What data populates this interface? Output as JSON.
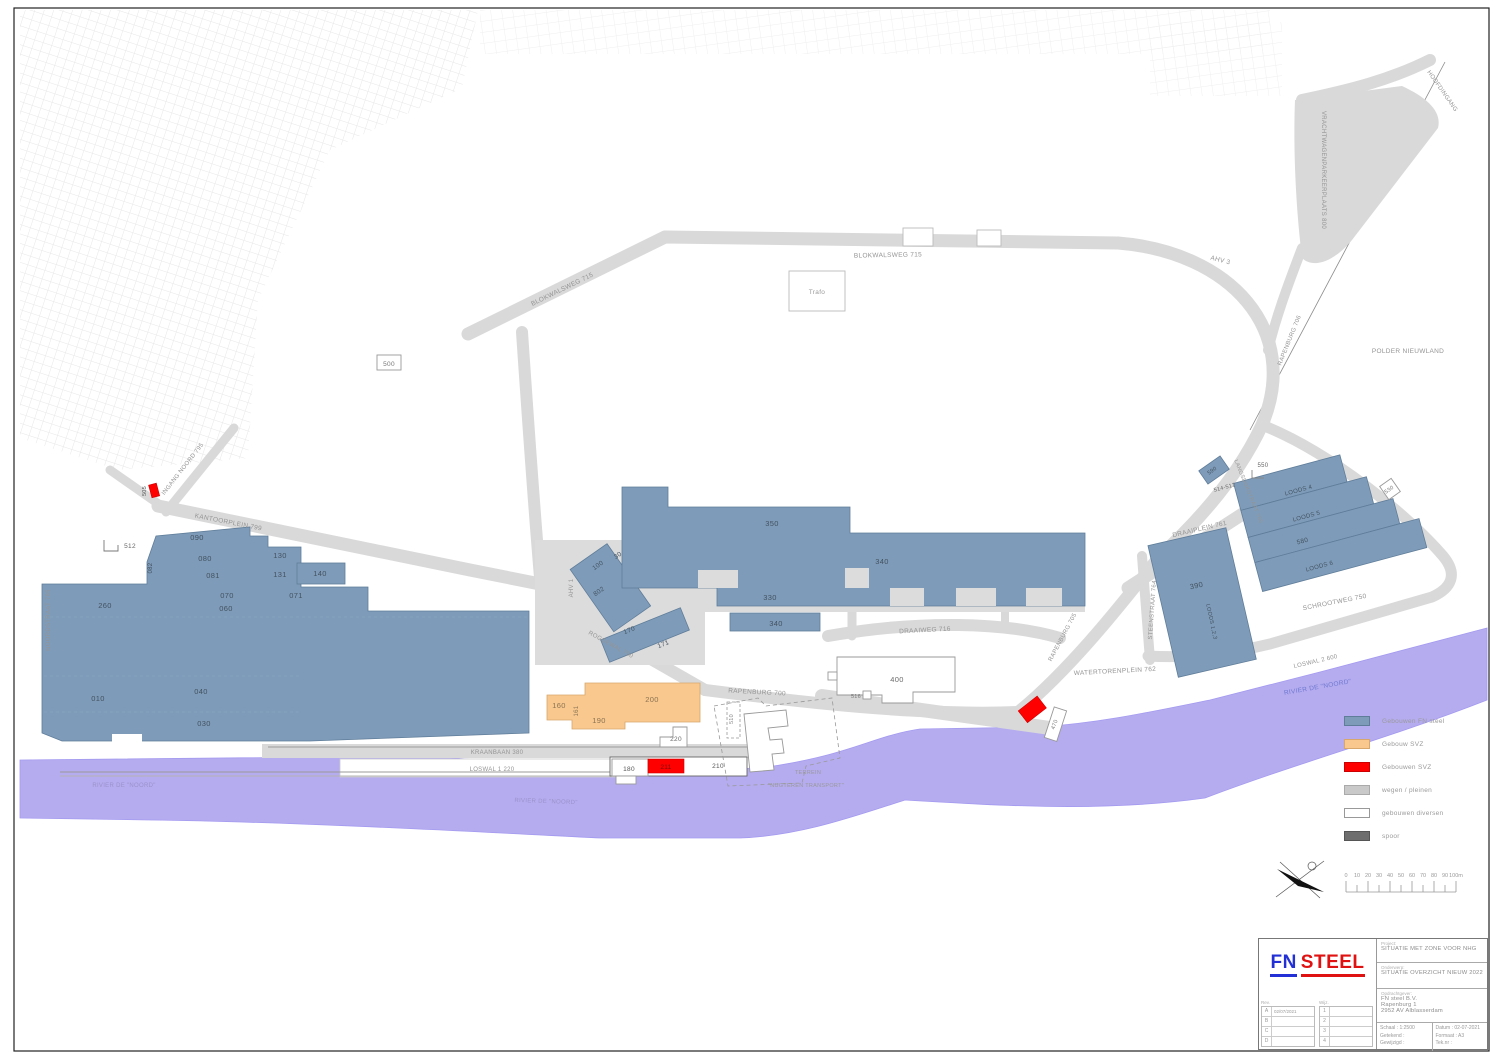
{
  "colors": {
    "fn_blue_building": "#7E9CBA",
    "svz_orange": "#F8C88F",
    "svz_red": "#FF0000",
    "road_gray": "#D9D9D9",
    "water_purple": "#B5ACF0",
    "spoor_gray": "#6E6E6E",
    "logo_blue": "#2230d6",
    "logo_red": "#e01111"
  },
  "map": {
    "road_labels": [
      {
        "name": "road-blokwalsweg-west",
        "text": "BLOKWALSWEG 715",
        "x": 563,
        "y": 291,
        "r": -26,
        "s": 6.5
      },
      {
        "name": "road-blokwalsweg",
        "text": "BLOKWALSWEG 715",
        "x": 888,
        "y": 257,
        "r": -1,
        "s": 6.5
      },
      {
        "name": "road-ahv-3",
        "text": "AHV 3",
        "x": 1220,
        "y": 262,
        "r": 14,
        "s": 6.5
      },
      {
        "name": "road-rapenburg-706",
        "text": "RAPENBURG 706",
        "x": 1291,
        "y": 341,
        "r": -68,
        "s": 6
      },
      {
        "name": "road-ingang-noord",
        "text": "INGANG NOORD 795",
        "x": 184,
        "y": 470,
        "r": -52,
        "s": 6
      },
      {
        "name": "road-noordstraat",
        "text": "NOORDSTRAAT 785",
        "x": 50,
        "y": 620,
        "r": -90,
        "s": 6
      },
      {
        "name": "road-kantoorplein",
        "text": "KANTOORPLEIN 799",
        "x": 228,
        "y": 524,
        "r": 11,
        "s": 6.5
      },
      {
        "name": "road-ahv-1",
        "text": "AHV 1",
        "x": 573,
        "y": 588,
        "r": -90,
        "s": 6
      },
      {
        "name": "road-roggewal",
        "text": "ROGGEWAL 750",
        "x": 610,
        "y": 646,
        "r": 29,
        "s": 6
      },
      {
        "name": "road-draaiweg",
        "text": "DRAAIWEG 716",
        "x": 925,
        "y": 632,
        "r": -3,
        "s": 6.5
      },
      {
        "name": "road-rapenburg-700",
        "text": "RAPENBURG 700",
        "x": 757,
        "y": 694,
        "r": 3,
        "s": 6.5
      },
      {
        "name": "road-rapenburg-705",
        "text": "RAPENBURG 705",
        "x": 1064,
        "y": 638,
        "r": -62,
        "s": 6
      },
      {
        "name": "road-watertorenplein",
        "text": "WATERTORENPLEIN 762",
        "x": 1115,
        "y": 673,
        "r": -3,
        "s": 6.5
      },
      {
        "name": "road-draaiplein",
        "text": "DRAAIPLEIN 761",
        "x": 1200,
        "y": 531,
        "r": -13,
        "s": 6.5
      },
      {
        "name": "road-steenstraat",
        "text": "STEENSTRAAT 764",
        "x": 1154,
        "y": 610,
        "r": -86,
        "s": 6
      },
      {
        "name": "road-langsdokstraat",
        "text": "LANGSDOKSTRAAT 765",
        "x": 1247,
        "y": 492,
        "r": 68,
        "s": 5.5
      },
      {
        "name": "road-schrootweg",
        "text": "SCHROOTWEG 750",
        "x": 1335,
        "y": 604,
        "r": -11,
        "s": 6.5
      },
      {
        "name": "road-loswal-2",
        "text": "LOSWAL 2 600",
        "x": 1316,
        "y": 663,
        "r": -13,
        "s": 6
      },
      {
        "name": "road-kraanbaan",
        "text": "KRAANBAAN 380",
        "x": 497,
        "y": 754,
        "r": 0,
        "s": 6
      },
      {
        "name": "road-loswal-1",
        "text": "LOSWAL 1 220",
        "x": 492,
        "y": 771,
        "r": 0,
        "s": 6
      },
      {
        "name": "road-hoofdingang",
        "text": "HOOFDINGANG",
        "x": 1441,
        "y": 92,
        "r": 55,
        "s": 6
      },
      {
        "name": "area-vrachtwagenparkeerplaats",
        "text": "VRACHTWAGENPARKEERPLAATS 800",
        "x": 1322,
        "y": 170,
        "r": 90,
        "s": 6
      },
      {
        "name": "area-polder-nieuwland",
        "text": "POLDER NIEUWLAND",
        "x": 1408,
        "y": 353,
        "r": 0,
        "s": 6.5
      }
    ],
    "building_labels": [
      {
        "name": "bldg-260",
        "text": "260",
        "x": 105,
        "y": 608
      },
      {
        "name": "bldg-090",
        "text": "090",
        "x": 197,
        "y": 540
      },
      {
        "name": "bldg-080",
        "text": "080",
        "x": 205,
        "y": 561
      },
      {
        "name": "bldg-081",
        "text": "081",
        "x": 213,
        "y": 578
      },
      {
        "name": "bldg-082",
        "text": "082",
        "x": 152,
        "y": 568,
        "r": -90,
        "s": 6
      },
      {
        "name": "bldg-130",
        "text": "130",
        "x": 280,
        "y": 558
      },
      {
        "name": "bldg-131",
        "text": "131",
        "x": 280,
        "y": 577
      },
      {
        "name": "bldg-140",
        "text": "140",
        "x": 320,
        "y": 576
      },
      {
        "name": "bldg-070",
        "text": "070",
        "x": 227,
        "y": 598
      },
      {
        "name": "bldg-060",
        "text": "060",
        "x": 226,
        "y": 611
      },
      {
        "name": "bldg-071",
        "text": "071",
        "x": 296,
        "y": 598
      },
      {
        "name": "bldg-010",
        "text": "010",
        "x": 98,
        "y": 701
      },
      {
        "name": "bldg-040",
        "text": "040",
        "x": 201,
        "y": 694
      },
      {
        "name": "bldg-030",
        "text": "030",
        "x": 204,
        "y": 726
      },
      {
        "name": "bldg-512",
        "text": "512",
        "x": 130,
        "y": 548,
        "s": 6.5,
        "c": "#666"
      },
      {
        "name": "bldg-505",
        "text": "505",
        "x": 146,
        "y": 491,
        "r": -90,
        "s": 5.5,
        "c": "#555"
      },
      {
        "name": "bldg-100",
        "text": "100",
        "x": 599,
        "y": 567,
        "r": -35,
        "s": 6.5
      },
      {
        "name": "bldg-30",
        "text": "30",
        "x": 619,
        "y": 557,
        "r": -35,
        "s": 6.5
      },
      {
        "name": "bldg-802",
        "text": "802",
        "x": 600,
        "y": 593,
        "r": -35,
        "s": 6.5
      },
      {
        "name": "bldg-170",
        "text": "170",
        "x": 630,
        "y": 632,
        "r": -22,
        "s": 6.5
      },
      {
        "name": "bldg-171",
        "text": "171",
        "x": 664,
        "y": 646,
        "r": -22,
        "s": 6.5
      },
      {
        "name": "bldg-350",
        "text": "350",
        "x": 772,
        "y": 526
      },
      {
        "name": "bldg-340",
        "text": "340",
        "x": 882,
        "y": 564
      },
      {
        "name": "bldg-330",
        "text": "330",
        "x": 770,
        "y": 600
      },
      {
        "name": "bldg-340-south",
        "text": "340",
        "x": 776,
        "y": 626
      },
      {
        "name": "parcel-500",
        "text": "500",
        "x": 389,
        "y": 366,
        "s": 6.5,
        "c": "#777"
      },
      {
        "name": "bldg-trafo",
        "text": "Trafo",
        "x": 817,
        "y": 294,
        "s": 6.5,
        "c": "#9a9a9a"
      },
      {
        "name": "bldg-400",
        "text": "400",
        "x": 897,
        "y": 682,
        "c": "#6b6b6b"
      },
      {
        "name": "bldg-516",
        "text": "516",
        "x": 856,
        "y": 698,
        "s": 5.5,
        "c": "#777"
      },
      {
        "name": "bldg-220",
        "text": "220",
        "x": 676,
        "y": 741,
        "s": 6.5,
        "c": "#6b6b6b"
      },
      {
        "name": "bldg-180",
        "text": "180",
        "x": 629,
        "y": 771,
        "s": 6.5,
        "c": "#555"
      },
      {
        "name": "bldg-211",
        "text": "211",
        "x": 666,
        "y": 769,
        "s": 6.5,
        "c": "#7a0000"
      },
      {
        "name": "bldg-210",
        "text": "210",
        "x": 718,
        "y": 768,
        "s": 6.5,
        "c": "#555"
      },
      {
        "name": "bldg-160",
        "text": "160",
        "x": 559,
        "y": 708,
        "c": "#8c7351"
      },
      {
        "name": "bldg-161",
        "text": "161",
        "x": 578,
        "y": 711,
        "r": -90,
        "s": 6,
        "c": "#8c7351"
      },
      {
        "name": "bldg-200",
        "text": "200",
        "x": 652,
        "y": 702,
        "c": "#8c7351"
      },
      {
        "name": "bldg-190",
        "text": "190",
        "x": 599,
        "y": 723,
        "c": "#8c7351"
      },
      {
        "name": "bldg-510",
        "text": "510",
        "x": 733,
        "y": 719,
        "r": -90,
        "s": 5.5,
        "c": "#888"
      },
      {
        "name": "bldg-470",
        "text": "470",
        "x": 1056,
        "y": 725,
        "r": -70,
        "s": 5.5,
        "c": "#777"
      },
      {
        "name": "bldg-390",
        "text": "390",
        "x": 1197,
        "y": 588,
        "r": -12
      },
      {
        "name": "bldg-loods-123",
        "text": "LOODS 1,2,3",
        "x": 1210,
        "y": 622,
        "r": 78,
        "s": 5.5
      },
      {
        "name": "bldg-loods-4",
        "text": "LOODS 4",
        "x": 1299,
        "y": 492,
        "r": -15,
        "s": 6
      },
      {
        "name": "bldg-loods-5",
        "text": "LOODS 5",
        "x": 1307,
        "y": 518,
        "r": -15,
        "s": 6
      },
      {
        "name": "bldg-580",
        "text": "580",
        "x": 1303,
        "y": 543,
        "r": -15,
        "s": 6.5
      },
      {
        "name": "bldg-loods-6",
        "text": "LOODS 6",
        "x": 1320,
        "y": 568,
        "r": -15,
        "s": 6
      },
      {
        "name": "bldg-590",
        "text": "590",
        "x": 1213,
        "y": 472,
        "r": -35,
        "s": 5.5
      },
      {
        "name": "bldg-550",
        "text": "550",
        "x": 1263,
        "y": 467,
        "s": 6,
        "c": "#666"
      },
      {
        "name": "bldg-514-512",
        "text": "514-512",
        "x": 1225,
        "y": 489,
        "r": -15,
        "s": 5.5,
        "c": "#666"
      },
      {
        "name": "bldg-530",
        "text": "530",
        "x": 1390,
        "y": 491,
        "r": -35,
        "s": 5.5,
        "c": "#777"
      }
    ],
    "water_labels": [
      {
        "name": "water-noord-west",
        "text": "RIVIER DE \"NOORD\"",
        "x": 124,
        "y": 787,
        "r": 0,
        "s": 6,
        "c": "#9a93c9"
      },
      {
        "name": "water-noord-mid",
        "text": "RIVIER DE \"NOORD\"",
        "x": 546,
        "y": 803,
        "r": 2,
        "s": 6,
        "c": "#9a93c9"
      },
      {
        "name": "water-noord-oost",
        "text": "RIVIER DE \"NOORD\"",
        "x": 1318,
        "y": 689,
        "r": -10,
        "s": 6.5,
        "c": "#6f79cf"
      }
    ],
    "area_labels": [
      {
        "name": "area-terrein",
        "text": "TERREIN",
        "x": 808,
        "y": 774,
        "s": 5.5,
        "c": "#999"
      },
      {
        "name": "area-nugteren",
        "text": "\"NUGTEREN TRANSPORT\"",
        "x": 806,
        "y": 787,
        "s": 5.5,
        "c": "#999"
      }
    ]
  },
  "legend": {
    "rows": [
      {
        "name": "legend-fn-steel",
        "color": "#7E9CBA",
        "border": "#5f7d99",
        "label": "Gebouwen FN steel"
      },
      {
        "name": "legend-gebouw-svz",
        "color": "#F8C88F",
        "border": "#d8a76c",
        "label": "Gebouw SVZ"
      },
      {
        "name": "legend-gebouwen-svz",
        "color": "#FF0000",
        "border": "#cc0000",
        "label": "Gebouwen SVZ"
      },
      {
        "name": "legend-wegen",
        "color": "#C9C9C9",
        "border": "#aaaaaa",
        "label": "wegen / pleinen"
      },
      {
        "name": "legend-diversen",
        "color": "#FFFFFF",
        "border": "#999999",
        "label": "gebouwen diversen"
      },
      {
        "name": "legend-spoor",
        "color": "#6E6E6E",
        "border": "#555555",
        "label": "spoor"
      }
    ]
  },
  "scalebar": {
    "labels": [
      "0",
      "10",
      "20",
      "30",
      "40",
      "50",
      "60",
      "70",
      "80",
      "90",
      "100m"
    ]
  },
  "titleblock": {
    "logo_fn": "FN",
    "logo_steel": "STEEL",
    "project_label": "Project:",
    "project": "SITUATIE MET ZONE VOOR NHG",
    "subject_label": "Onderwerp:",
    "subject": "SITUATIE OVERZICHT NIEUW 2022",
    "client_label": "Opdrachtgever:",
    "client_lines": [
      "FN steel B.V.",
      "Rapenburg 1",
      "2952 AV Alblasserdam"
    ],
    "scale_label": "Schaal :",
    "scale": "1:2500",
    "drawn_label": "Getekend :",
    "drawn": "",
    "changed_label": "Gewijzigd :",
    "changed": "",
    "date_label": "Datum :",
    "date": "02-07-2021",
    "format_label": "Formaat :",
    "format": "A3",
    "dwg_label": "Tek.nr :",
    "dwg": "",
    "rev_caption": "Rev.",
    "wijz_caption": "Wijz.",
    "rev_rows": [
      {
        "k": "A",
        "v": "02/07/2021"
      },
      {
        "k": "B",
        "v": ""
      },
      {
        "k": "C",
        "v": ""
      },
      {
        "k": "D",
        "v": ""
      }
    ],
    "wijz_rows": [
      {
        "k": "1",
        "v": ""
      },
      {
        "k": "2",
        "v": ""
      },
      {
        "k": "3",
        "v": ""
      },
      {
        "k": "4",
        "v": ""
      }
    ]
  }
}
